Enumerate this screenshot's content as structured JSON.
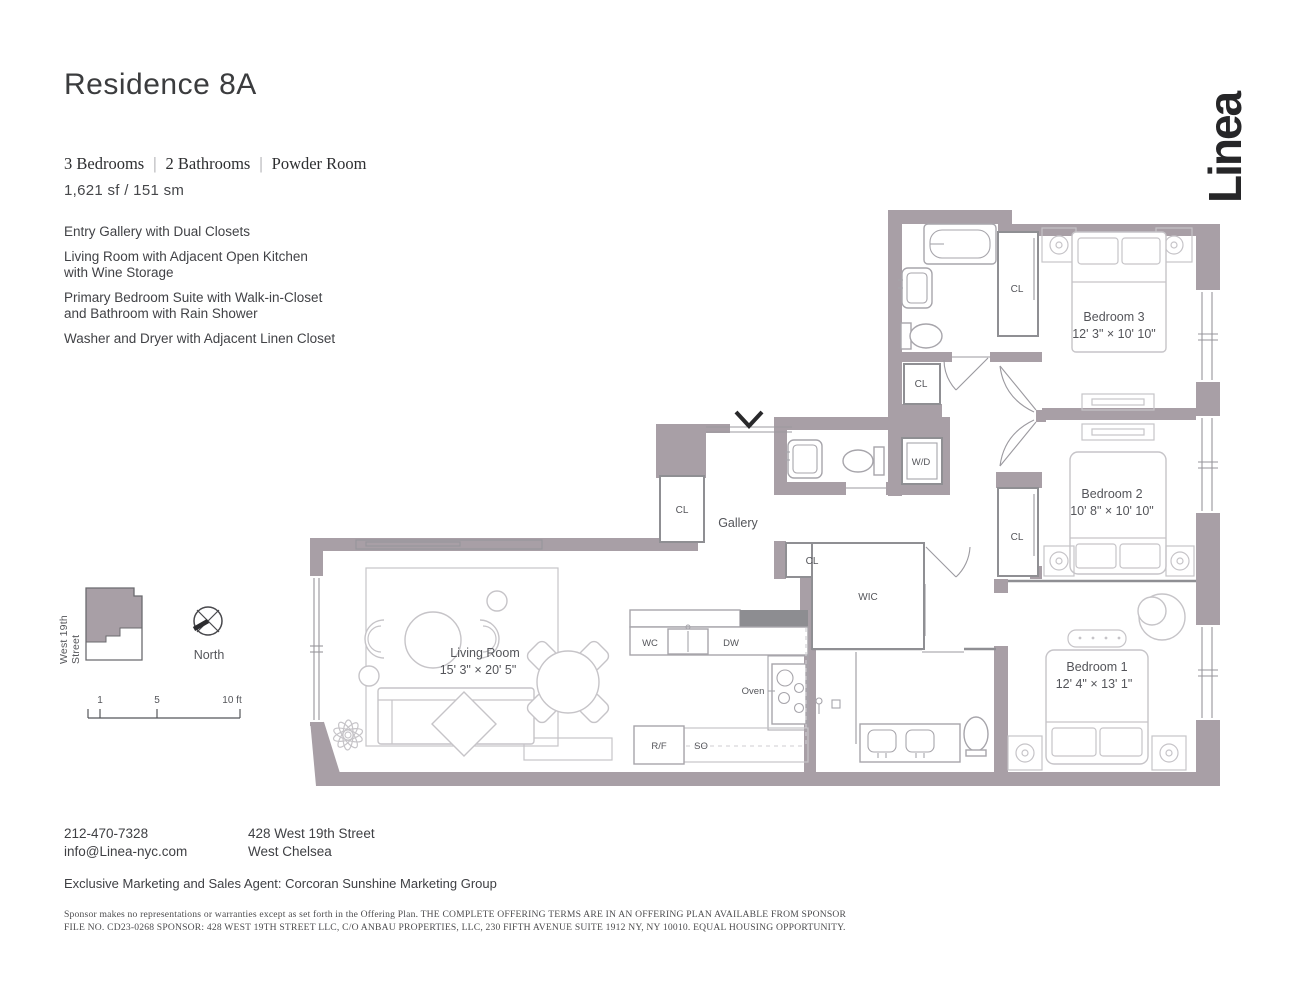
{
  "header": {
    "title": "Residence 8A",
    "spec_bedrooms": "3 Bedrooms",
    "spec_bathrooms": "2 Bathrooms",
    "spec_powder": "Powder Room",
    "spec_divider": "|",
    "area": "1,621 sf / 151 sm",
    "features": [
      "Entry Gallery with Dual Closets",
      "Living Room with Adjacent Open Kitchen\nwith Wine Storage",
      "Primary Bedroom Suite with Walk-in-Closet\nand Bathroom with Rain Shower",
      "Washer and Dryer with Adjacent Linen Closet"
    ]
  },
  "logo": {
    "text": "Linea"
  },
  "plan": {
    "bedroom3_name": "Bedroom 3",
    "bedroom3_dims": "12' 3\" × 10' 10\"",
    "bedroom2_name": "Bedroom 2",
    "bedroom2_dims": "10' 8\" × 10' 10\"",
    "bedroom1_name": "Bedroom 1",
    "bedroom1_dims": "12' 4\" × 13' 1\"",
    "living_name": "Living Room",
    "living_dims": "15' 3\" × 20' 5\"",
    "gallery": "Gallery",
    "wic": "WIC",
    "cl": "CL",
    "wd": "W/D",
    "wc": "WC",
    "dw": "DW",
    "oven": "Oven",
    "rf": "R/F",
    "so": "SO"
  },
  "keyplan": {
    "street": "West 19th Street",
    "north": "North",
    "scale_1": "1",
    "scale_5": "5",
    "scale_10": "10 ft"
  },
  "footer": {
    "phone": "212-470-7328",
    "email": "info@Linea-nyc.com",
    "address1": "428 West 19th Street",
    "address2": "West Chelsea",
    "agent": "Exclusive Marketing and Sales Agent: Corcoran Sunshine Marketing Group",
    "legal1": "Sponsor makes no representations or warranties except as set forth in the Offering Plan. THE COMPLETE OFFERING TERMS ARE IN AN OFFERING PLAN AVAILABLE FROM SPONSOR",
    "legal2": "FILE NO. CD23-0268 SPONSOR: 428 WEST 19TH STREET LLC, C/O ANBAU PROPERTIES, LLC, 230 FIFTH AVENUE SUITE 1912 NY, NY 10010. EQUAL HOUSING OPPORTUNITY."
  },
  "colors": {
    "wall": "#a89fa6",
    "ink": "#262628"
  }
}
